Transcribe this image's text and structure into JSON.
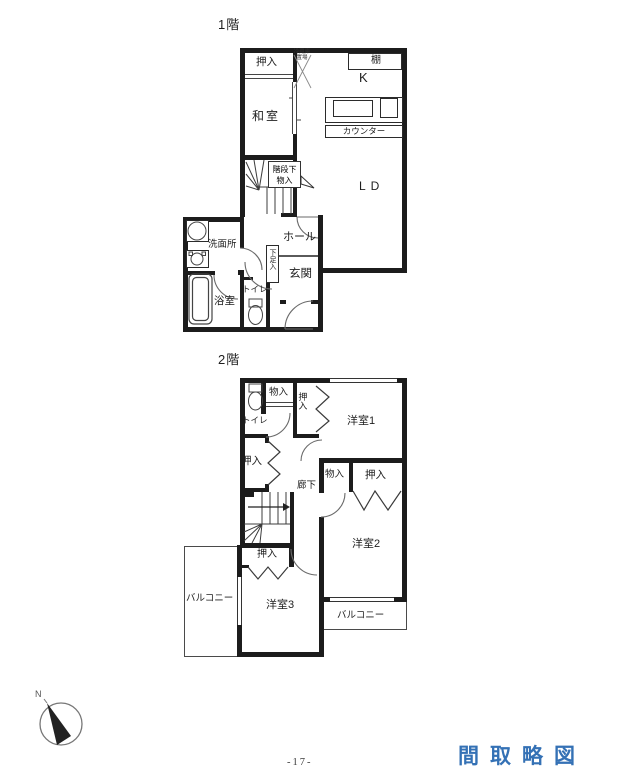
{
  "page": {
    "title": "間取略図",
    "page_number": "-17-",
    "title_color": "#3471b5"
  },
  "floor1": {
    "label": "1階",
    "rooms": {
      "oshiire": "押入",
      "washitsu": "和室",
      "kitchen": "K",
      "shelf": "棚",
      "counter": "カウンター",
      "living": "LD",
      "fridge_line1": "冷蔵庫",
      "fridge_line2": "置場",
      "stair_callout_line1": "階段下",
      "stair_callout_line2": "物入",
      "senmenjo": "洗面所",
      "hall": "ホール",
      "genkan": "玄関",
      "shoebox": "下足入",
      "toilet": "トイレ",
      "bath": "浴室"
    }
  },
  "floor2": {
    "label": "2階",
    "rooms": {
      "toilet": "トイレ",
      "storage_top": "物入",
      "closet_room1": "押入",
      "room1": "洋室1",
      "closet_hall": "押入",
      "corridor": "廊下",
      "storage_mid": "物入",
      "closet_mid": "押入",
      "room2": "洋室2",
      "closet_room3": "押入",
      "room3": "洋室3",
      "balcony_left": "バルコニー",
      "balcony_bottom": "バルコニー"
    }
  },
  "compass": {
    "north_label": "N"
  }
}
